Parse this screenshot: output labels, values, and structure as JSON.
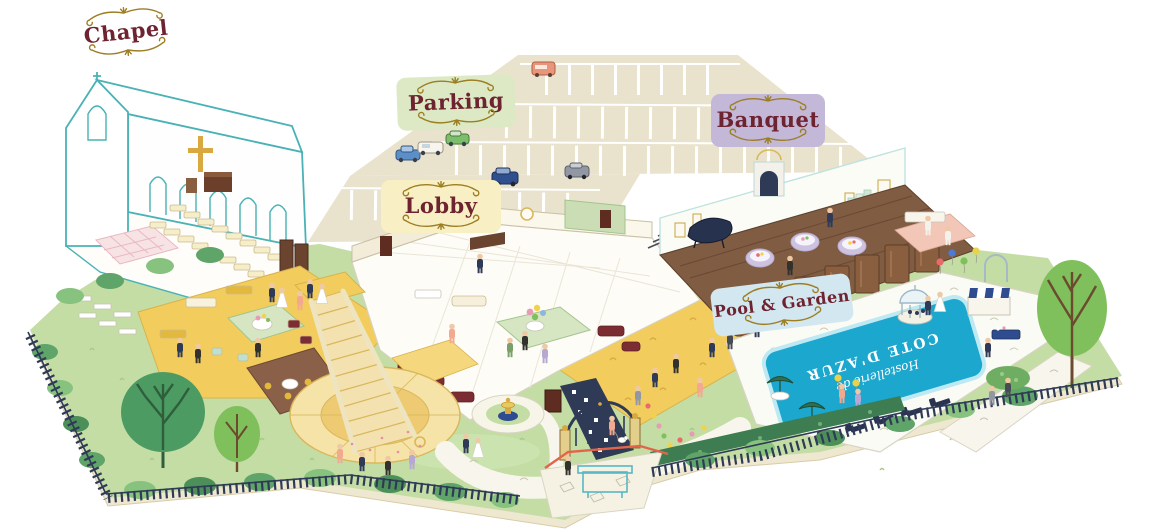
{
  "labels": {
    "chapel": "Chapel",
    "parking": "Parking",
    "lobby": "Lobby",
    "banquet": "Banquet",
    "pool_garden": "Pool & Garden"
  },
  "pool_text": {
    "script": "Hostellerie de",
    "caps": "COTE D'AZUR"
  },
  "colors": {
    "ornament_gold": "#9C7E23",
    "label_text_maroon": "#6E2430",
    "plate_chapel_bg": "#FFFFFF",
    "plate_parking_bg": "#DCE9C4",
    "plate_lobby_bg": "#F8F0C4",
    "plate_banquet_bg": "#C3B8D8",
    "plate_pool_bg": "#D2E7EF",
    "pool_water": "#1CA7CF",
    "lawn_green": "#C3DDA4",
    "parking_beige": "#E9E2CC",
    "banquet_floor_brown": "#7F5C42",
    "gold_carpet": "#F2CD5E",
    "chapel_line_teal": "#49B2B5",
    "fence_navy": "#2E3A56",
    "tree_green_dark": "#4C9B62",
    "tree_green_light": "#7FBF5C",
    "furniture_maroon": "#7C2D33"
  }
}
